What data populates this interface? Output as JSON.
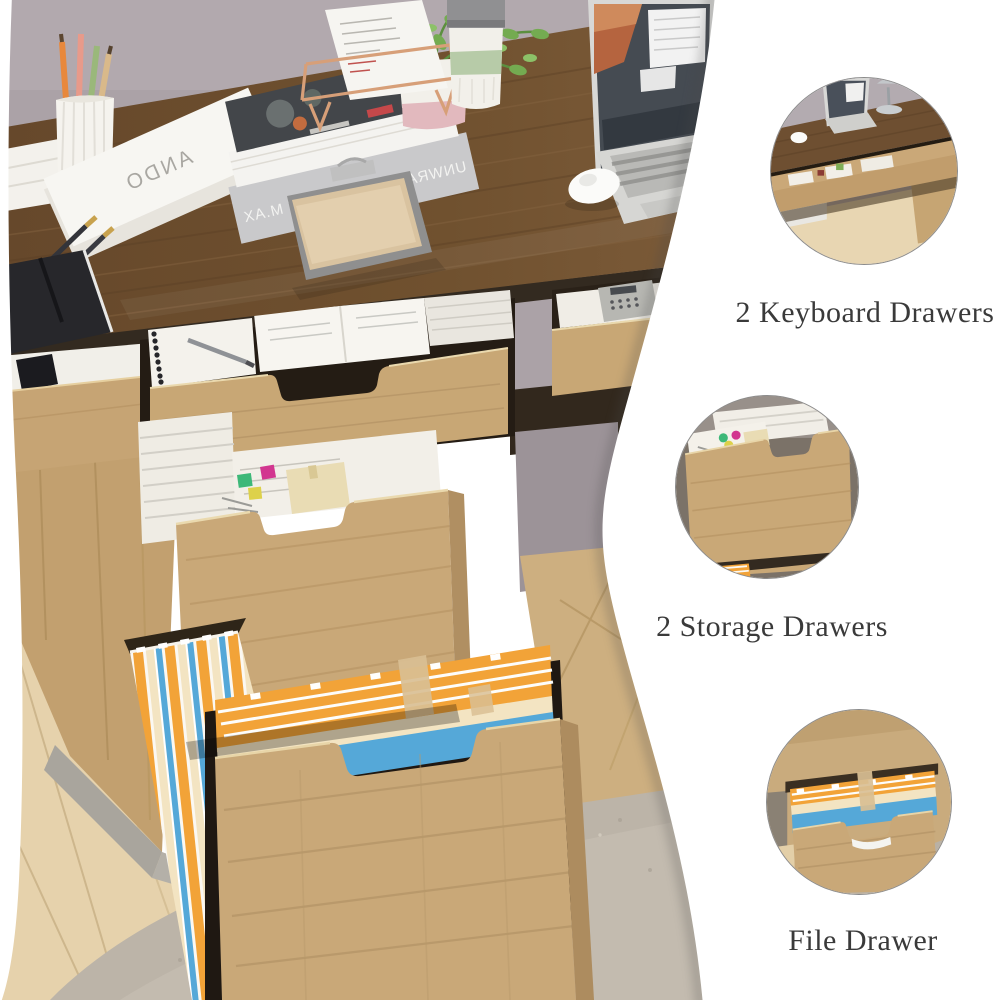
{
  "meta": {
    "type": "product-photo",
    "subject": "Home office desk with two keyboard drawers, two storage drawers and a file drawer shown open"
  },
  "photo": {
    "book_spine_title": "ANDO",
    "book_cover_title": "UNWRAP UVW MAP BY M.AX",
    "colors": {
      "wall": "#aba2a7",
      "desktop_wood": "#6e4e30",
      "cabinet_wood": "#c9a878",
      "floor": "#e6d2ac",
      "rug": "#bcb4a8",
      "panel": "#ffffff",
      "folder_orange": "#f2a338",
      "folder_blue": "#55a8d8",
      "folder_cream": "#f3e4c2",
      "clip_green": "#3db878",
      "clip_magenta": "#d2368f",
      "clip_yellow": "#ddd14a"
    }
  },
  "callouts": [
    {
      "id": "keyboard-drawers",
      "label": "2 Keyboard Drawers",
      "inset": "closeup-photo-keyboard-drawer"
    },
    {
      "id": "storage-drawers",
      "label": "2 Storage Drawers",
      "inset": "closeup-photo-storage-drawer"
    },
    {
      "id": "file-drawer",
      "label": "File Drawer",
      "inset": "closeup-photo-file-drawer"
    }
  ],
  "style": {
    "caption_color": "#3a3a3a",
    "circle_border": "#8b8b8b"
  }
}
